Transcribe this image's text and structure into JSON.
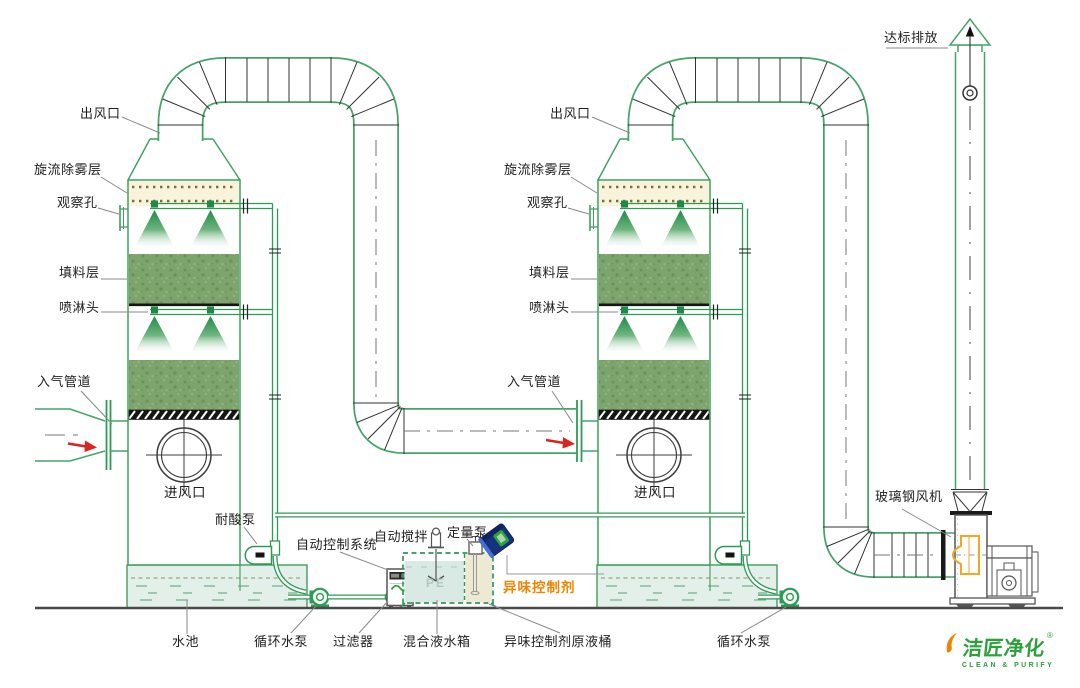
{
  "towers": {
    "tower1": {
      "outlet": "出风口",
      "demister": "旋流除雾层",
      "inspection_port": "观察孔",
      "packing": "填料层",
      "spray_nozzle": "喷淋头",
      "gas_inlet_duct": "入气管道",
      "air_inlet": "进风口",
      "acid_pump": "耐酸泵"
    },
    "tower2": {
      "outlet": "出风口",
      "demister": "旋流除雾层",
      "inspection_port": "观察孔",
      "packing": "填料层",
      "spray_nozzle": "喷淋头",
      "gas_inlet_duct": "入气管道",
      "air_inlet": "进风口"
    }
  },
  "equipment": {
    "control_system": "自动控制系统",
    "auto_stirrer": "自动搅拌",
    "metering_pump": "定量泵",
    "odor_agent": "异味控制剂",
    "water_pool": "水池",
    "circulating_pump_1": "循环水泵",
    "filter": "过滤器",
    "mixing_tank": "混合液水箱",
    "agent_barrel": "异味控制剂原液桶",
    "circulating_pump_2": "循环水泵",
    "tank_material": "PE"
  },
  "exhaust": {
    "emission": "达标排放",
    "fan": "玻璃钢风机"
  },
  "logo": {
    "brand": "洁匠净化",
    "registered": "®",
    "tagline": "CLEAN & PURIFY"
  },
  "colors": {
    "line_green": "#3f9f5f",
    "pipe_green": "#2f9a55",
    "packing_green": "#7da46c",
    "demister_cream": "#faf3dc",
    "water_blue": "#e3efe9",
    "compartment_beige": "#eee9d2",
    "accent_orange": "#f08300",
    "arrow_red": "#d9251d",
    "barrel_navy": "#16327e",
    "logo_green": "#2ba13a"
  }
}
